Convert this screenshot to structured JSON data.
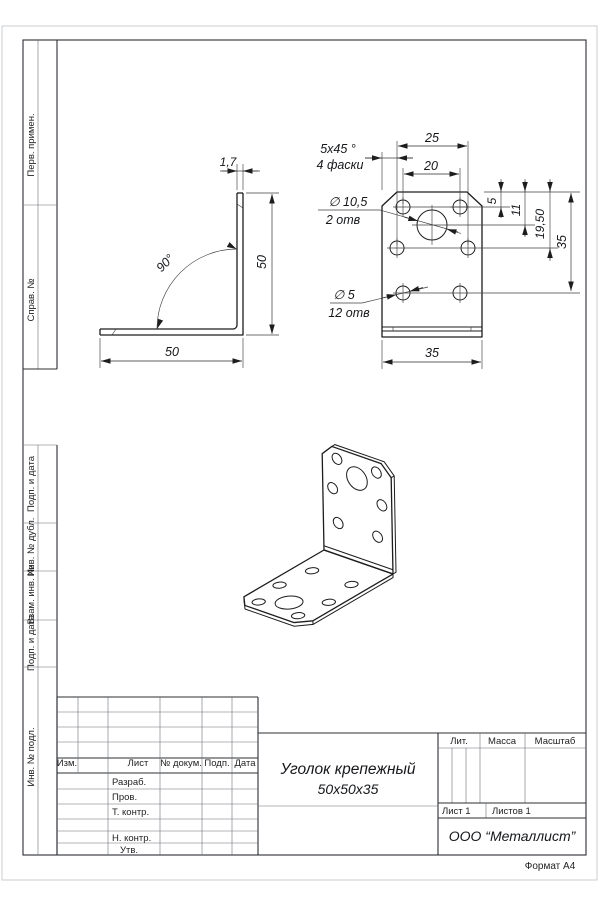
{
  "page": {
    "format_note": "Формат А4"
  },
  "colors": {
    "ink": "#1d1d1d",
    "paper_edge": "#c9ccd1"
  },
  "sidebar_top": {
    "items": [
      "Перв. примен.",
      "Справ. №"
    ]
  },
  "sidebar_bottom": {
    "items": [
      "Подп. и дата",
      "Инв. № дубл.",
      "Взам. инв. №",
      "Подп. и дата",
      "Инв. № подл."
    ]
  },
  "side_view": {
    "thickness": "1,7",
    "angle": "90°",
    "height": "50",
    "width": "50"
  },
  "front_view": {
    "top_dim_outer": "25",
    "top_dim_inner": "20",
    "right_dim_1": "5",
    "right_dim_2": "11",
    "right_dim_3": "19,50",
    "right_dim_4": "35",
    "bottom_dim": "35",
    "chamfer_note": [
      "5х45 °",
      "4 фаски"
    ],
    "big_holes_note": [
      "∅ 10,5",
      "2 отв"
    ],
    "small_holes_note": [
      "∅ 5",
      "12 отв"
    ]
  },
  "title_block": {
    "rev_header": [
      "Изм.",
      "Лист",
      "№ докум.",
      "Подп.",
      "Дата"
    ],
    "staff_labels": [
      "Разраб.",
      "Пров.",
      "Т. контр.",
      "Н. контр.",
      "Утв."
    ],
    "part_name": [
      "Уголок крепежный",
      "50х50х35"
    ],
    "lit_label": "Лит.",
    "mass_label": "Масса",
    "scale_label": "Масштаб",
    "sheet_label": "Лист 1",
    "sheets_label": "Листов 1",
    "company": "ООО “Металлист”"
  }
}
